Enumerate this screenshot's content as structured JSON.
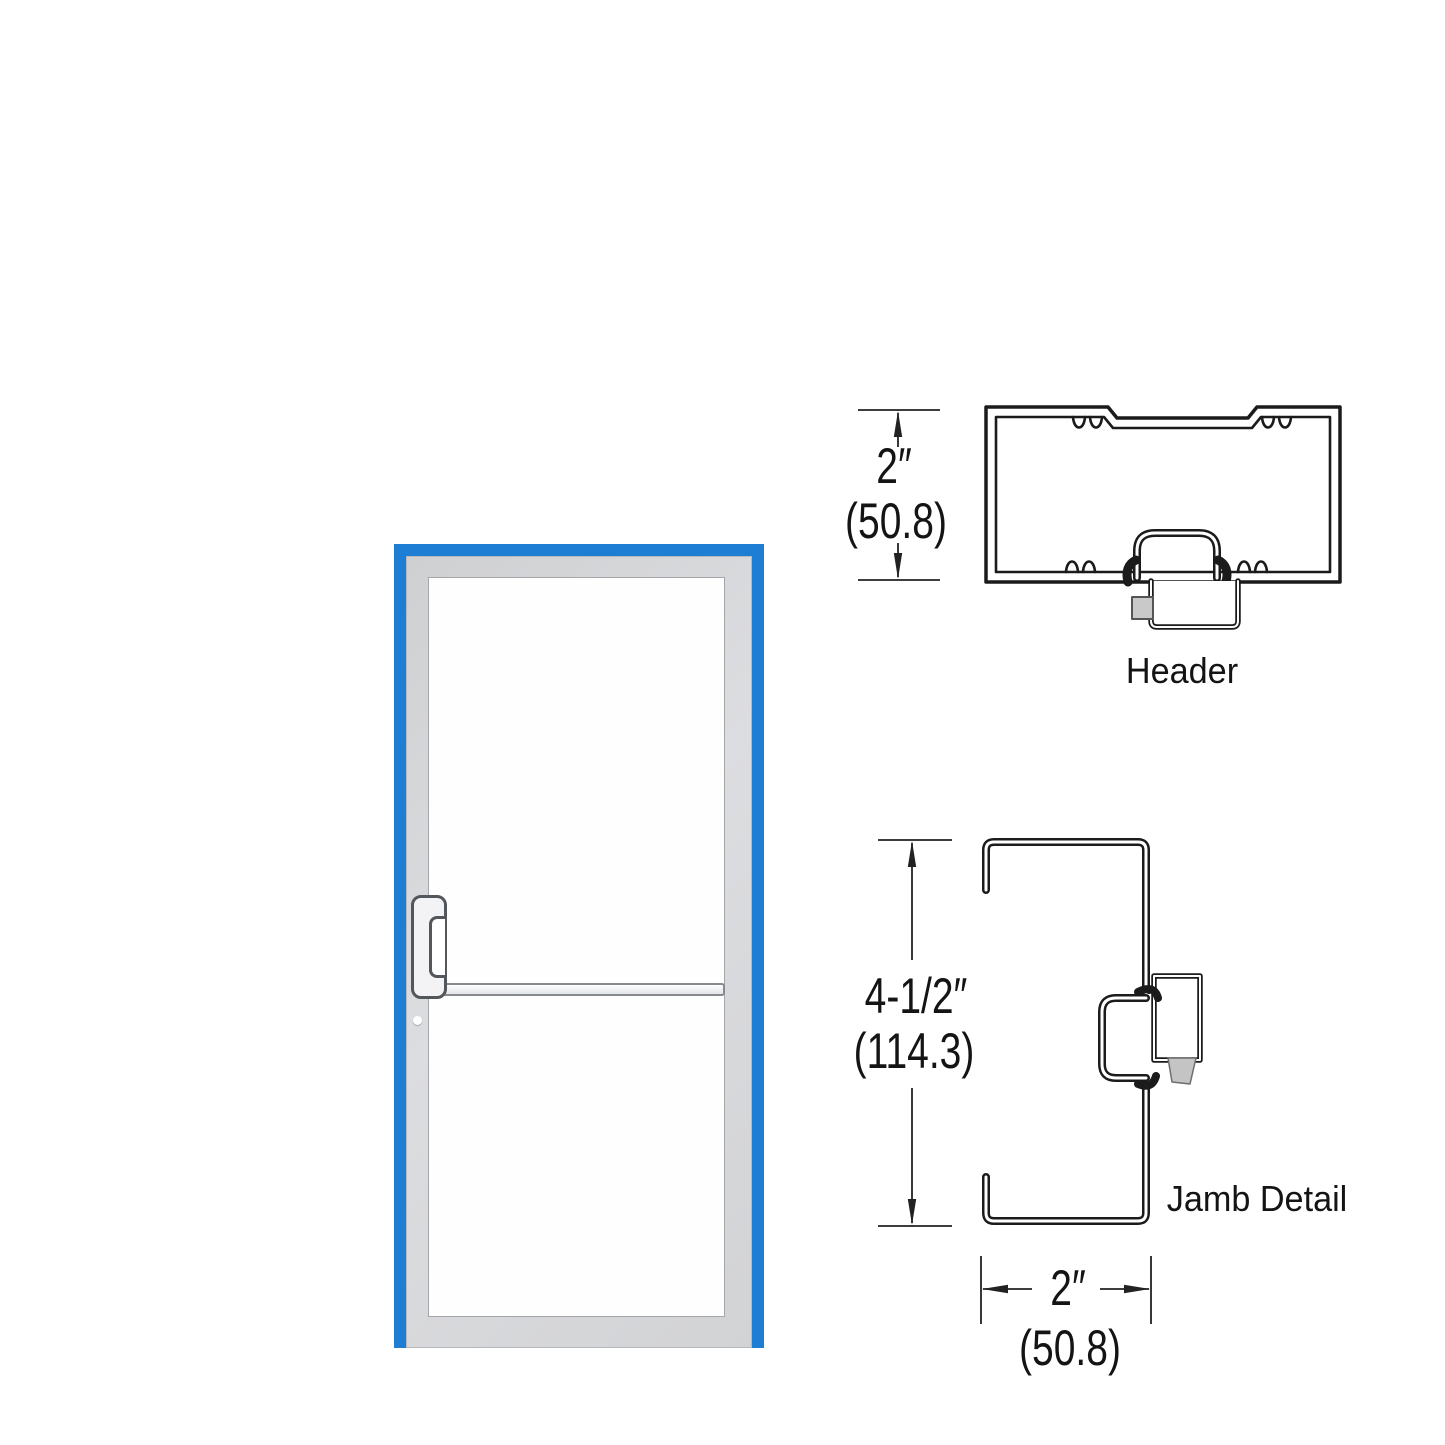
{
  "door": {
    "frame_color": "#1D7ED4",
    "leaf_color": "#D6D7D9",
    "glass_color": "#FFFFFF",
    "line_color": "#1B1B1B"
  },
  "details": {
    "header": {
      "label": "Header",
      "height_in": "2″",
      "height_mm": "(50.8)"
    },
    "jamb": {
      "label": "Jamb Detail",
      "depth_in": "4-1/2″",
      "depth_mm": "(114.3)",
      "width_in": "2″",
      "width_mm": "(50.8)"
    }
  }
}
